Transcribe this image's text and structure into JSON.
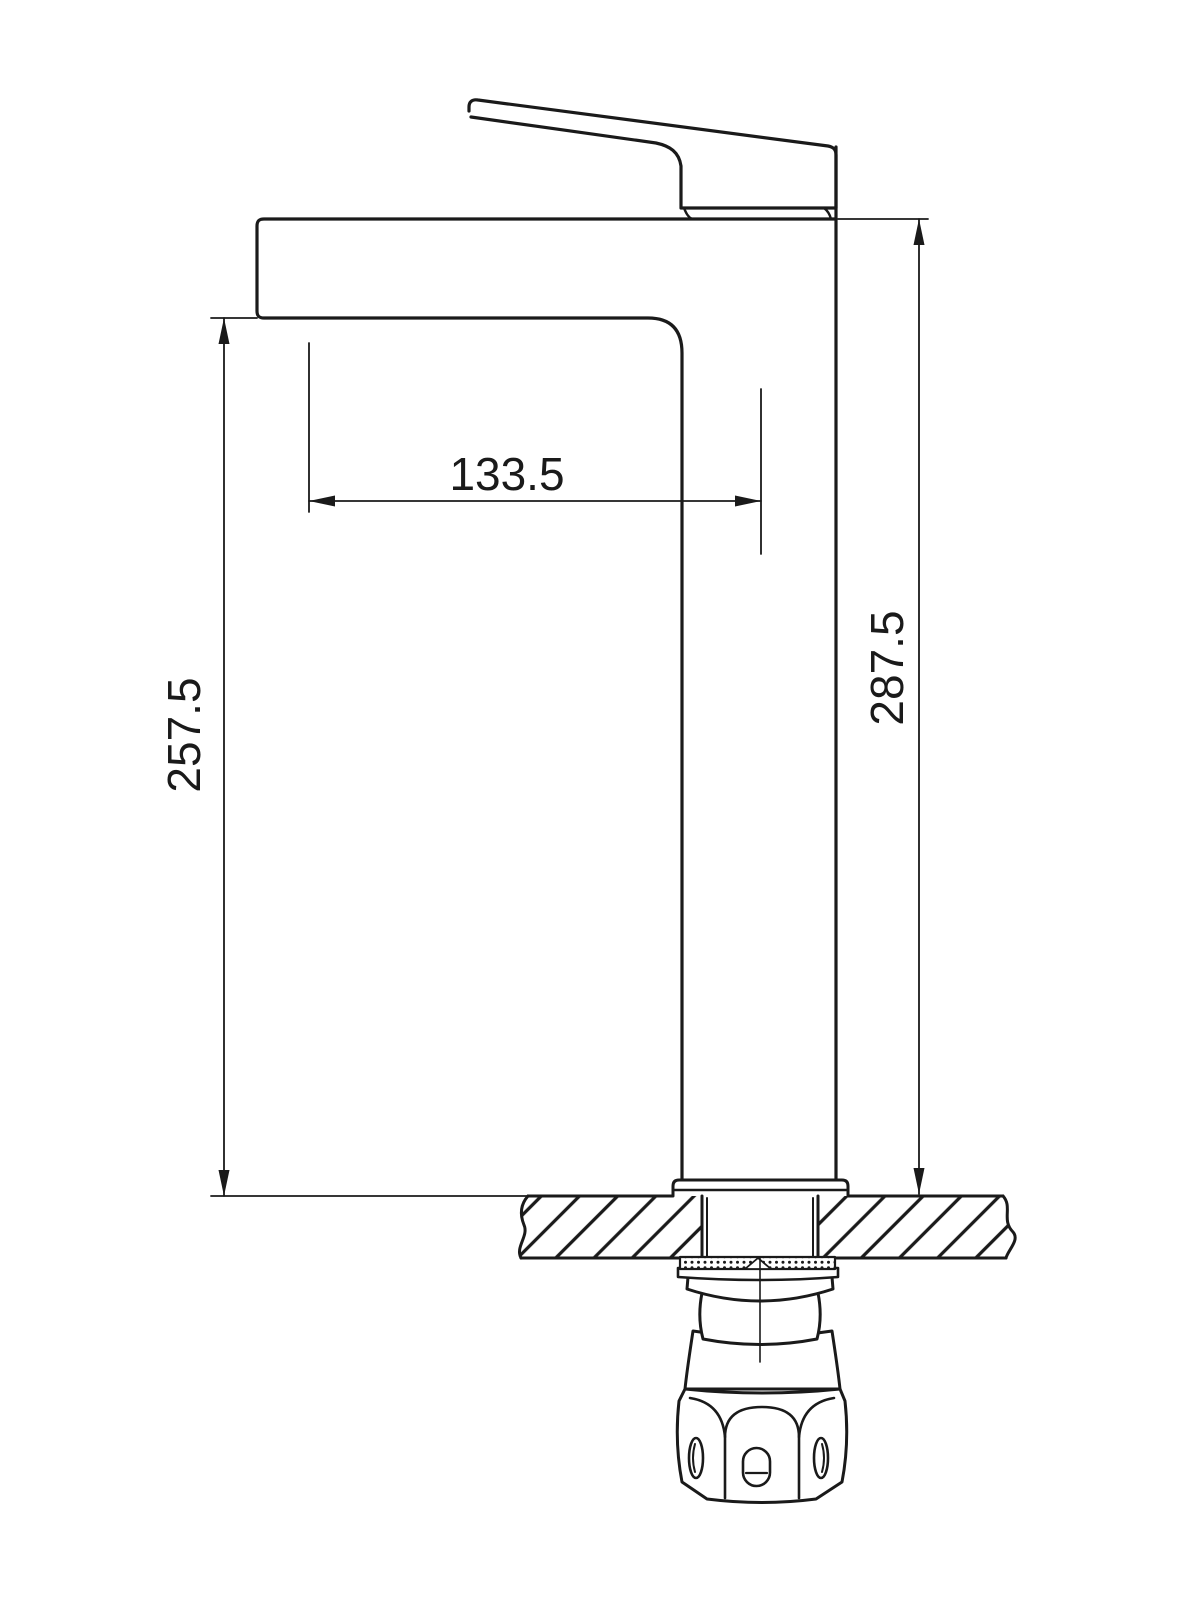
{
  "drawing": {
    "background": "#ffffff",
    "line_color": "#1a1a1a",
    "dimensions": {
      "spout_reach": "133.5",
      "spout_height": "257.5",
      "overall_height": "287.5"
    }
  }
}
